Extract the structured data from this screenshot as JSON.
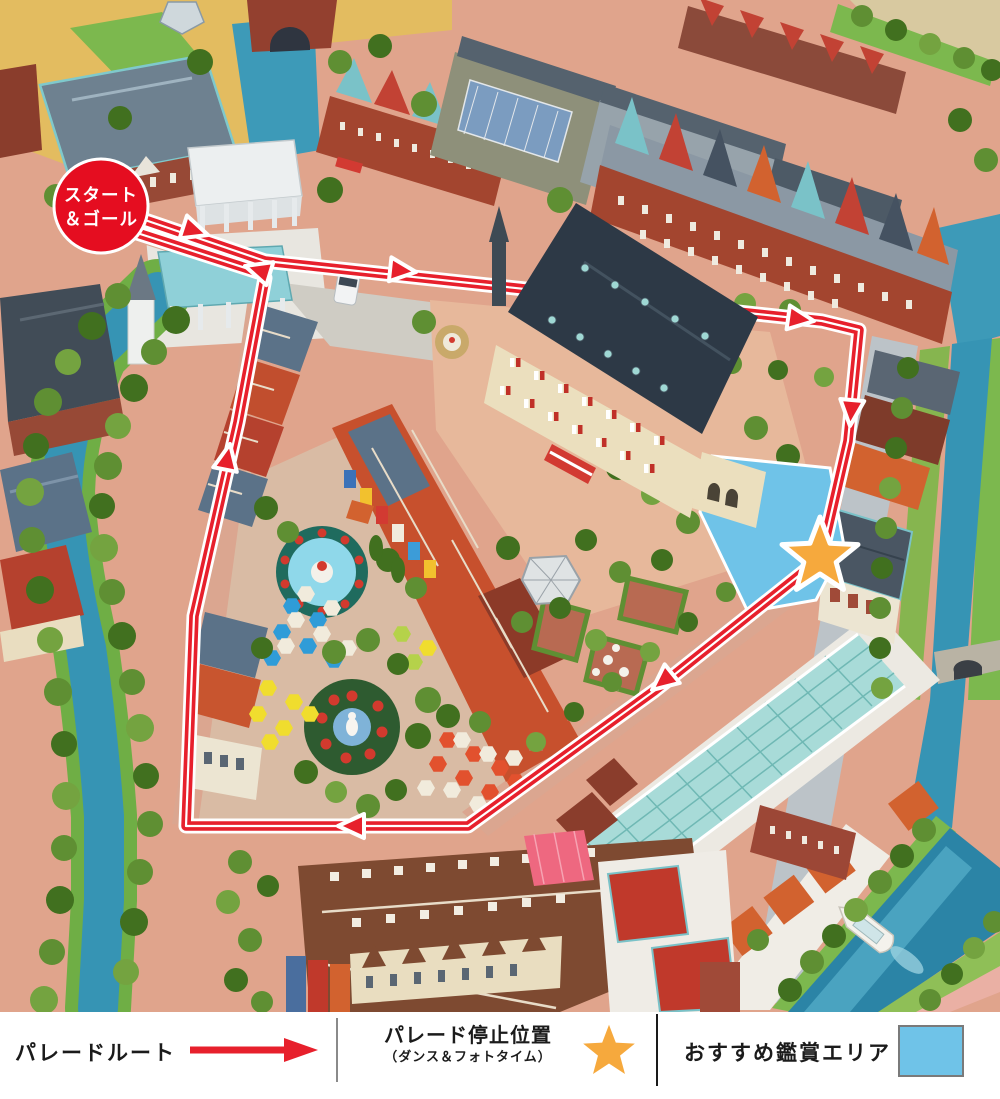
{
  "map": {
    "badge_line1": "スタート",
    "badge_line2": "＆ゴール",
    "markers": {
      "start_goal": "red-circle-badge",
      "parade_stop": "orange-star",
      "viewing_area": "blue-polygon"
    }
  },
  "legend": {
    "route_label": "パレードルート",
    "stop_label": "パレード停止位置",
    "stop_sublabel": "（ダンス＆フォトタイム）",
    "viewing_label": "おすすめ鑑賞エリア"
  },
  "icons": {
    "route": "red-arrow-right-icon",
    "stop": "orange-star-icon",
    "viewing": "blue-rectangle-swatch"
  },
  "colors": {
    "route_red": "#e7202c",
    "badge_red": "#e50d20",
    "star_orange": "#f6a93d",
    "viewing_blue": "#6fc3e8",
    "water_teal": "#3694b4",
    "ground_salmon": "#e0a48c"
  }
}
